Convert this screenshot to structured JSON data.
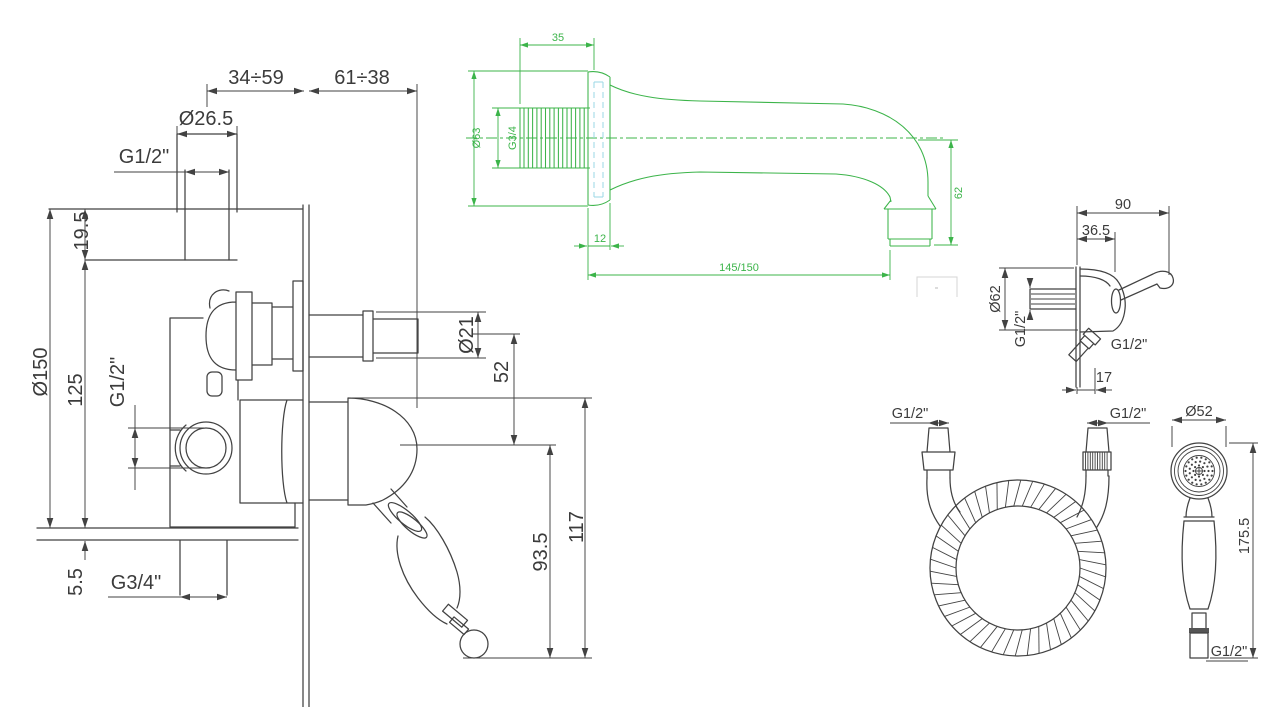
{
  "drawing": {
    "background": "#ffffff",
    "colors": {
      "line": "#424242",
      "green": "#3cb44a",
      "cyan": "#9ad7e6",
      "faint": "#d6d6d6"
    },
    "mixer": {
      "dims": {
        "depth_range_a": "34÷59",
        "depth_range_b": "61÷38",
        "riser_od": "Ø26.5",
        "riser_thread": "G1/2\"",
        "plate_offset": "19.5",
        "plate_diameter": "Ø150",
        "body_height": "125",
        "side_port_thread": "G1/2\"",
        "plate_thickness": "5.5",
        "bottom_outlet_thread": "G3/4\"",
        "spindle_diameter": "Ø21",
        "axis_distance": "52",
        "handle_length": "93.5",
        "handle_overall": "117"
      }
    },
    "spout": {
      "dims": {
        "thread_length": "35",
        "flange_diameter": "Ø63",
        "thread": "G3/4",
        "flange_depth": "12",
        "reach": "145/150",
        "drop_height": "62"
      }
    },
    "bracket": {
      "dims": {
        "overall_depth": "90",
        "body_depth": "36.5",
        "flange_diameter": "Ø62",
        "inlet_thread": "G1/2\"",
        "outlet_thread": "G1/2\"",
        "outlet_offset": "17"
      }
    },
    "hose": {
      "dims": {
        "left_connection": "G1/2\"",
        "right_connection": "G1/2\""
      }
    },
    "handshower": {
      "dims": {
        "head_diameter": "Ø52",
        "overall_length": "175.5",
        "connection_thread": "G1/2\""
      }
    }
  }
}
